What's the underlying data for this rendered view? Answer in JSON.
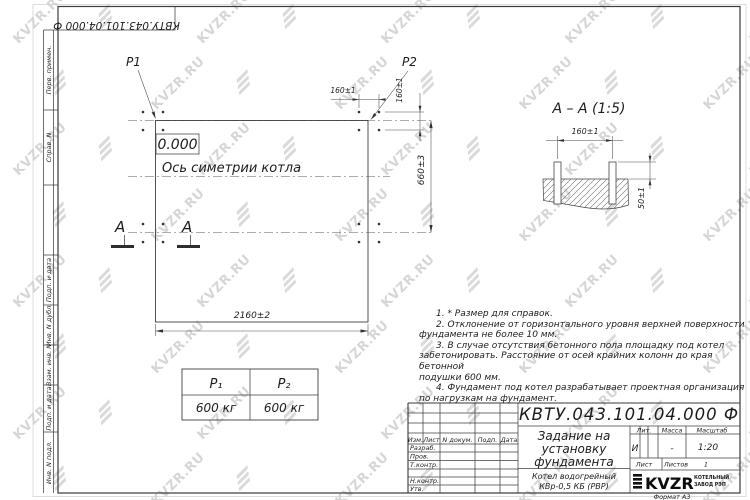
{
  "watermark": {
    "text": "KVZR.RU",
    "color": "#b6b6b6"
  },
  "corner_stamp": {
    "designation": "КВТУ.043.101.04.000  Ф"
  },
  "side_strip": {
    "labels": [
      "Перв. примен.",
      "Справ. N",
      "",
      "Подп. и дата",
      "Инв. N дубл.",
      "Взам. инв. N",
      "Подп. и дата",
      "Инв. N подл."
    ]
  },
  "plan": {
    "p1": "P1",
    "p2": "P2",
    "elevation": "0.000",
    "axis_label": "Ось симетрии котла",
    "dim_width": "2160±2",
    "dim_height": "660±3",
    "dim_bolt_h": "160±1",
    "dim_bolt_v": "160±1",
    "section_letter": "A"
  },
  "section": {
    "title": "A – A (1:5)",
    "dim_bolts": "160±1",
    "dim_height": "50±1"
  },
  "loads_table": {
    "headers": [
      "P₁",
      "P₂"
    ],
    "values": [
      "600 кг",
      "600 кг"
    ]
  },
  "notes": {
    "lines": [
      {
        "text": "1. * Размер для справок.",
        "indent": true
      },
      {
        "text": "2. Отклонение от горизонтального уровня верхней поверхности",
        "indent": true
      },
      {
        "text": "фундамента не более 10 мм.",
        "indent": false
      },
      {
        "text": "3. В случае отсутствия бетонного пола площадку под котел",
        "indent": true
      },
      {
        "text": "забетонировать. Расстояние от осей крайних колонн до края бетонной",
        "indent": false
      },
      {
        "text": "подушки 600 мм.",
        "indent": false
      },
      {
        "text": "4. Фундамент под котел разрабатывает проектная организация",
        "indent": true
      },
      {
        "text": "по нагрузкам на фундамент.",
        "indent": false
      }
    ]
  },
  "titleblock": {
    "designation": "КВТУ.043.101.04.000  Ф",
    "doc_title_lines": [
      "Задание на",
      "установку",
      "фундамента"
    ],
    "product_lines": [
      "Котел водогрейный",
      "КВр-0,5  КБ  (РВР)"
    ],
    "header_cols": [
      "Изм.",
      "Лист",
      "N докум.",
      "Подп.",
      "Дата"
    ],
    "sig_rows": [
      "Разраб.",
      "Пров.",
      "Т.контр.",
      "Н.контр.",
      "Утв."
    ],
    "lit_label": "Лит.",
    "lit_value": "И",
    "mass_label": "Масса",
    "mass_value": "-",
    "scale_label": "Масштаб",
    "scale_value": "1:20",
    "sheet_label": "Лист",
    "sheets_label": "Листов",
    "sheets_value": "1",
    "company": {
      "logo": "KVZR",
      "line1": "КОТЕЛЬНЫЙ",
      "line2": "ЗАВОД РЭП"
    },
    "format_label": "Формат А3"
  }
}
